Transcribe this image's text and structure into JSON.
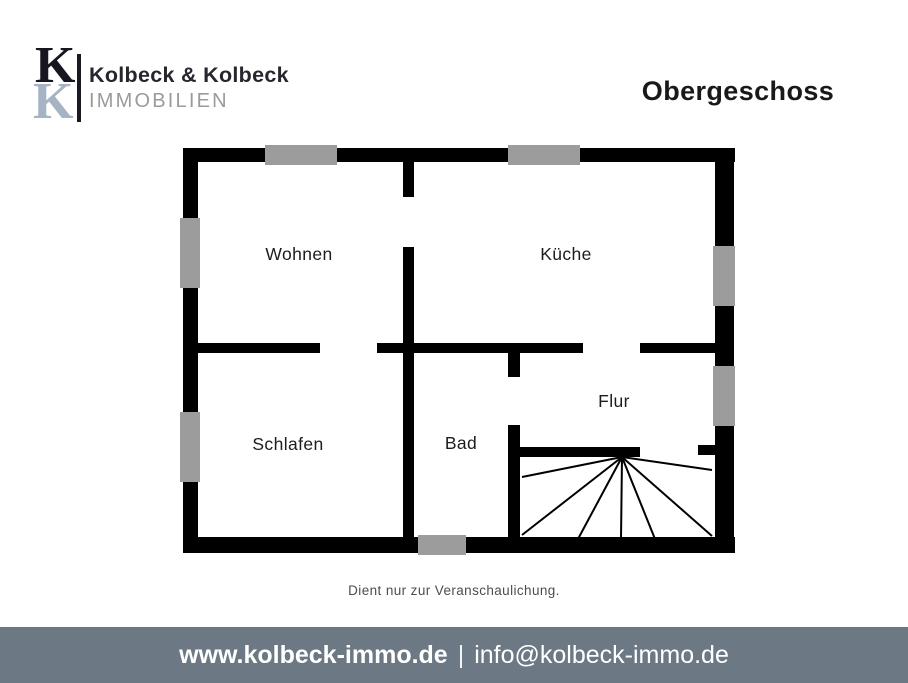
{
  "header": {
    "logo": {
      "k_top": "K",
      "k_bottom": "K",
      "name": "Kolbeck & Kolbeck",
      "subtitle": "IMMOBILIEN"
    },
    "title": "Obergeschoss"
  },
  "floorplan": {
    "rooms": [
      {
        "label": "Wohnen"
      },
      {
        "label": "Küche"
      },
      {
        "label": "Schlafen"
      },
      {
        "label": "Bad"
      },
      {
        "label": "Flur"
      }
    ],
    "features": [
      "windows",
      "door-openings",
      "winder-staircase"
    ]
  },
  "disclaimer": "Dient nur zur Veranschaulichung.",
  "footer": {
    "website": "www.kolbeck-immo.de",
    "separator": "|",
    "email": "info@kolbeck-immo.de"
  },
  "colors": {
    "wall": "#000000",
    "window_gray": "#9c9c9c",
    "footer_bg": "#6c7883",
    "logo_k_top": "#16161e",
    "logo_k_bottom": "#a6b3c4",
    "logo_subtitle": "#9b9b9b",
    "text_dark": "#191919"
  }
}
